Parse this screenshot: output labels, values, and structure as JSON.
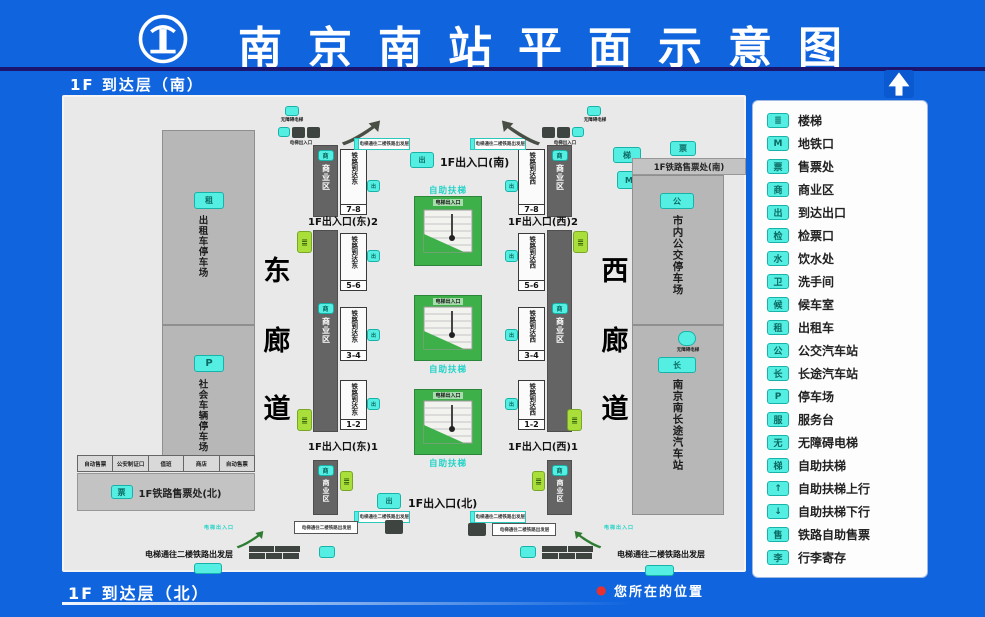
{
  "colors": {
    "background_blue": "#1065DF",
    "panel_gray": "#E9E9E9",
    "zone_gray": "#B7B7B7",
    "platform_bar_dark": "#646464",
    "cyan_icon": "#55EEE2",
    "escalator_green": "#3EB04A",
    "stairs_lime": "#AADE3B",
    "navy_divider": "#1A1670",
    "marker_red": "#E8312F"
  },
  "header": {
    "title": "南京南站平面示意图",
    "floor_top": "1F  到达层（南）"
  },
  "footer": {
    "floor_bottom": "1F  到达层（北）",
    "marker": "●",
    "location_label": "您所在的位置"
  },
  "legend": {
    "items": [
      {
        "name": "stairs-icon",
        "glyph": "≣",
        "label": "楼梯"
      },
      {
        "name": "metro-icon",
        "glyph": "M",
        "label": "地铁口"
      },
      {
        "name": "ticket-office-icon",
        "glyph": "票",
        "label": "售票处"
      },
      {
        "name": "commerce-icon",
        "glyph": "商",
        "label": "商业区"
      },
      {
        "name": "arrival-exit-icon",
        "glyph": "出",
        "label": "到达出口"
      },
      {
        "name": "check-gate-icon",
        "glyph": "检",
        "label": "检票口"
      },
      {
        "name": "water-icon",
        "glyph": "水",
        "label": "饮水处"
      },
      {
        "name": "restroom-icon",
        "glyph": "卫",
        "label": "洗手间"
      },
      {
        "name": "waiting-room-icon",
        "glyph": "候",
        "label": "候车室"
      },
      {
        "name": "taxi-icon",
        "glyph": "租",
        "label": "出租车"
      },
      {
        "name": "bus-station-icon",
        "glyph": "公",
        "label": "公交汽车站"
      },
      {
        "name": "coach-station-icon",
        "glyph": "长",
        "label": "长途汽车站"
      },
      {
        "name": "parking-icon",
        "glyph": "P",
        "label": "停车场"
      },
      {
        "name": "service-desk-icon",
        "glyph": "服",
        "label": "服务台"
      },
      {
        "name": "accessible-elevator-icon",
        "glyph": "无",
        "label": "无障碍电梯"
      },
      {
        "name": "escalator-icon",
        "glyph": "梯",
        "label": "自助扶梯"
      },
      {
        "name": "escalator-up-icon",
        "glyph": "↑",
        "label": "自助扶梯上行"
      },
      {
        "name": "escalator-down-icon",
        "glyph": "↓",
        "label": "自助扶梯下行"
      },
      {
        "name": "rail-self-ticket-icon",
        "glyph": "售",
        "label": "铁路自助售票"
      },
      {
        "name": "luggage-icon",
        "glyph": "李",
        "label": "行李寄存"
      }
    ]
  },
  "map": {
    "corridor_east": [
      "东",
      "廊",
      "道"
    ],
    "corridor_west": [
      "西",
      "廊",
      "道"
    ],
    "taxi_parking": "出租车停车场",
    "social_parking": "社会车辆停车场",
    "rooms": [
      "自动售票",
      "公安制证口",
      "值班",
      "商店",
      "自动售票"
    ],
    "ticket_north": "1F铁路售票处(北)",
    "ticket_south": "1F铁路售票处(南)",
    "city_bus": "市内公交停车场",
    "coach": "南京南长途汽车站",
    "commerce": "商业区",
    "exits": {
      "south": "1F出入口(南)",
      "north": "1F出入口(北)",
      "east1": "1F出入口(东)1",
      "east2": "1F出入口(东)2",
      "west1": "1F出入口(西)1",
      "west2": "1F出入口(西)2"
    },
    "platforms_east": [
      {
        "label": "铁路到达东",
        "num": "7-8"
      },
      {
        "label": "铁路到达东",
        "num": "5-6"
      },
      {
        "label": "铁路到达东",
        "num": "3-4"
      },
      {
        "label": "铁路到达东",
        "num": "1-2"
      }
    ],
    "platforms_west": [
      {
        "label": "铁路到达西",
        "num": "7-8"
      },
      {
        "label": "铁路到达西",
        "num": "5-6"
      },
      {
        "label": "铁路到达西",
        "num": "3-4"
      },
      {
        "label": "铁路到达西",
        "num": "1-2"
      }
    ],
    "esc_label": "电梯出入口",
    "esc_cyan_label": "自助扶梯",
    "elevator_note": "电梯通往二楼铁路出发层",
    "accessible_label": "无障碍电梯",
    "icons": {
      "taxi": "租",
      "parking": "P",
      "ticket": "票",
      "commerce": "商",
      "arrival": "出",
      "stairs": "≣",
      "bus": "公",
      "coach": "长",
      "metro": "M",
      "escalator": "梯"
    }
  }
}
